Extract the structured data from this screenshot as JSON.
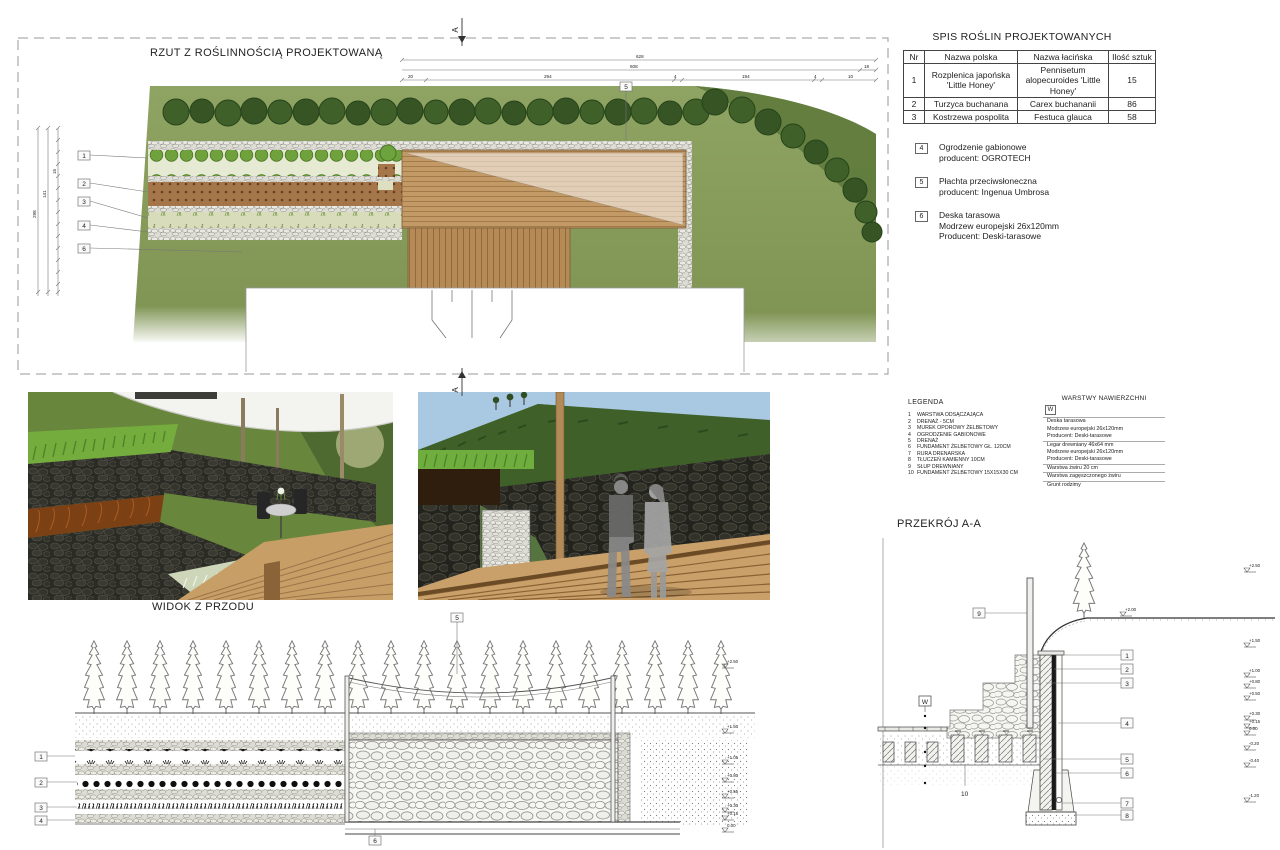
{
  "plan": {
    "title": "RZUT Z ROŚLINNOŚCIĄ PROJEKTOWANĄ",
    "section_marker": "A",
    "callouts": {
      "c1": "1",
      "c2": "2",
      "c3": "3",
      "c4": "4",
      "c5": "5",
      "c6": "6"
    },
    "dims": {
      "total": "628",
      "sub": "608",
      "right": "18",
      "segs": [
        "20",
        "294",
        "4",
        "194",
        "4",
        "10"
      ],
      "left": [
        "298",
        "141",
        "15"
      ]
    }
  },
  "plant_table": {
    "title": "SPIS ROŚLIN PROJEKTOWANYCH",
    "headers": [
      "Nr",
      "Nazwa polska",
      "Nazwa łacińska",
      "Ilość sztuk"
    ],
    "rows": [
      [
        "1",
        "Rozplenica japońska 'Little Honey'",
        "Pennisetum alopecuroides 'Little Honey'",
        "15"
      ],
      [
        "2",
        "Turzyca buchanana",
        "Carex buchananii",
        "86"
      ],
      [
        "3",
        "Kostrzewa pospolita",
        "Festuca glauca",
        "58"
      ]
    ]
  },
  "notes": [
    {
      "num": "4",
      "lines": [
        "Ogrodzenie gabionowe",
        "producent: OGROTECH"
      ]
    },
    {
      "num": "5",
      "lines": [
        "Płachta przeciwsłoneczna",
        "producent: Ingenua Umbrosa"
      ]
    },
    {
      "num": "6",
      "lines": [
        "Deska tarasowa",
        "Modrzew europejski 26x120mm",
        "Producent: Deski-tarasowe"
      ]
    }
  ],
  "legenda": {
    "title": "LEGENDA",
    "items": [
      {
        "num": "1",
        "text": "WARSTWA ODSĄCZAJĄCA"
      },
      {
        "num": "2",
        "text": "DRENAŻ - 5CM"
      },
      {
        "num": "3",
        "text": "MUREK OPOROWY ŻELBETOWY"
      },
      {
        "num": "4",
        "text": "OGRODZENIE GABIONOWE"
      },
      {
        "num": "5",
        "text": "DRENAŻ"
      },
      {
        "num": "6",
        "text": "FUNDAMENT ŻELBETOWY GŁ. 120CM"
      },
      {
        "num": "7",
        "text": "RURA DRENARSKA"
      },
      {
        "num": "8",
        "text": "TŁUCZEŃ KAMIENNY 10CM"
      },
      {
        "num": "9",
        "text": "SŁUP DREWNIANY"
      },
      {
        "num": "10",
        "text": "FUNDAMENT ŻELBETOWY 15X15X30 CM"
      }
    ]
  },
  "warstwy": {
    "title": "WARSTWY NAWIERZCHNI",
    "marker": "W",
    "lines": [
      "Deska tarasowa",
      "Modrzew europejski 26x120mm",
      "Producent: Deski-tarasowe",
      "Legar drewniany 46x64 mm",
      "Modrzew europejski 26x120mm",
      "Producent: Deski-tarasowe",
      "Warstwa żwiru 20 cm",
      "Warstwa zagęszczonego żwiru",
      "Grunt rodzimy"
    ]
  },
  "front_view": {
    "title": "WIDOK Z PRZODU",
    "callouts": [
      "1",
      "2",
      "3",
      "4"
    ],
    "top_label": "5",
    "bottom_label": "6",
    "elevations": [
      "+2.50",
      "+1.50",
      "+1.05",
      "+0.80",
      "+0.55",
      "+0.30",
      "+0.15",
      "0.00"
    ]
  },
  "section": {
    "title": "PRZEKRÓJ A-A",
    "marker": "W",
    "callouts": [
      "1",
      "2",
      "3",
      "4",
      "5",
      "6",
      "7",
      "8"
    ],
    "post_label": "9",
    "foundation_label": "10",
    "ground_elevation": "+2.00",
    "elevations": [
      "+2.50",
      "+1.50",
      "+1.00",
      "+0.80",
      "+0.50",
      "+0.30",
      "+0.15",
      "0.00",
      "-0.20",
      "-0.40",
      "-1.20"
    ]
  }
}
